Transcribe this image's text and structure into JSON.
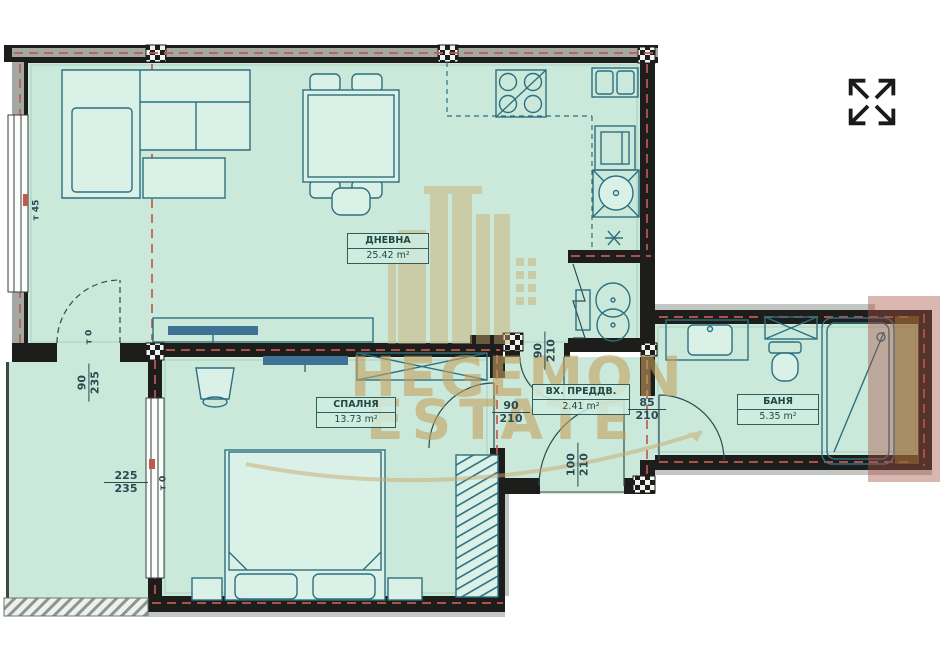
{
  "watermark": {
    "line1": "HEGEMON",
    "line2": "ESTATE"
  },
  "controls": {
    "fullscreen_label": "expand fullscreen"
  },
  "rooms": [
    {
      "name": "ДНЕВНА",
      "area": "25.42 m²"
    },
    {
      "name": "СПАЛНЯ",
      "area": "13.73 m²"
    },
    {
      "name": "ВХ. ПРЕДДВ.",
      "area": "2.41 m²"
    },
    {
      "name": "БАНЯ",
      "area": "5.35 m²"
    }
  ],
  "dims": {
    "d1": {
      "num": "90",
      "den": "235"
    },
    "d2": {
      "num": "225",
      "den": "235"
    },
    "d3": {
      "num": "90",
      "den": "210"
    },
    "d4": {
      "num": "90",
      "den": "210"
    },
    "d5": {
      "num": "85",
      "den": "210"
    },
    "d6": {
      "num": "100",
      "den": "210"
    }
  },
  "heights": {
    "h1": "т 45",
    "h2": "т 0",
    "h3": "т 0"
  },
  "colors": {
    "room-fill": "#cbe9da",
    "wall-dark": "#1d1d1b",
    "wall-gray": "#a2a9a3",
    "line-teal": "#2e6f80",
    "red-dash": "#c05a50",
    "brown-overlay": "#a65245",
    "brown-strip": "#96732f",
    "watermark-gold": "#c9a86b",
    "label-ink": "#1d4a45"
  }
}
